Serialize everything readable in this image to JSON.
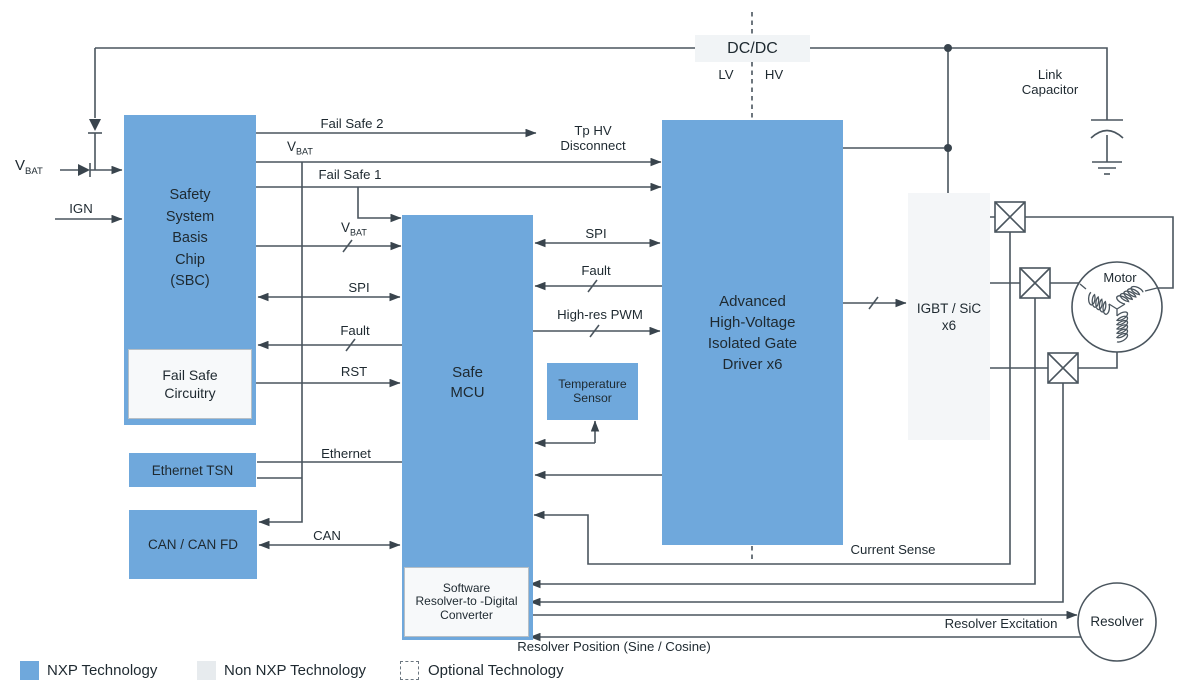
{
  "colors": {
    "nxp_blue": "#6FA8DC",
    "non_nxp_gray": "#E7EBEE",
    "line": "#4A555E",
    "text": "#1E2930"
  },
  "inputs": {
    "vbat_v": "V",
    "vbat_sub": "BAT",
    "ign": "IGN"
  },
  "blocks": {
    "sbc": "Safety\nSystem\nBasis\nChip\n(SBC)",
    "fail_safe_circuitry": "Fail Safe\nCircuitry",
    "mcu": "Safe\nMCU",
    "sw_resolver_converter": "Software\nResolver-to -Digital\nConverter",
    "gate_driver": "Advanced\nHigh-Voltage\nIsolated Gate\nDriver x6",
    "temp_sensor": "Temperature\nSensor",
    "ethernet_tsn": "Ethernet TSN",
    "can_fd": "CAN / CAN FD",
    "dcdc": "DC/DC",
    "igbt_sic": "IGBT / SiC\nx6",
    "motor": "Motor",
    "resolver": "Resolver",
    "link_capacitor": "Link\nCapacitor"
  },
  "signals": {
    "fail_safe_2": "Fail Safe 2",
    "fail_safe_1": "Fail Safe 1",
    "tp_hv_disconnect": "Tp HV\nDisconnect",
    "spi_sbc": "SPI",
    "fault_sbc": "Fault",
    "rst": "RST",
    "ethernet": "Ethernet",
    "can": "CAN",
    "spi_driver": "SPI",
    "fault_driver": "Fault",
    "high_res_pwm": "High-res PWM",
    "lv": "LV",
    "hv": "HV",
    "current_sense": "Current Sense",
    "resolver_excitation": "Resolver Excitation",
    "resolver_position": "Resolver Position (Sine / Cosine)"
  },
  "legend": [
    {
      "label": "NXP Technology"
    },
    {
      "label": "Non NXP Technology"
    },
    {
      "label": "Optional Technology"
    }
  ]
}
